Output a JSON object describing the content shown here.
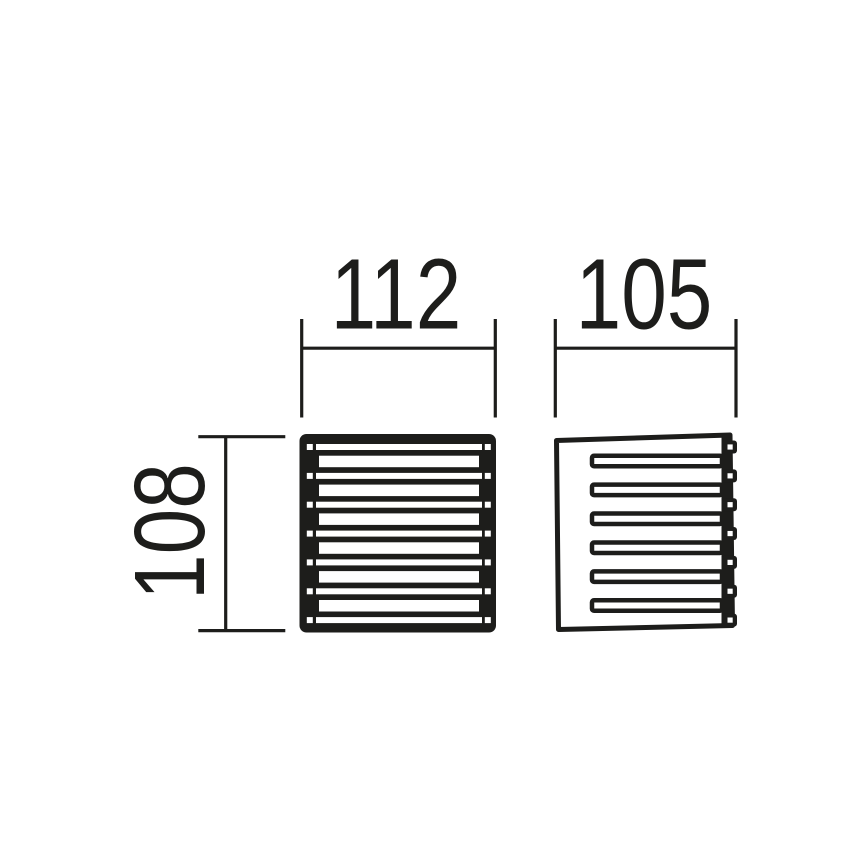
{
  "page": {
    "background_color": "#ffffff",
    "ink_color": "#1d1d1b"
  },
  "drawing": {
    "kind": "technical-dimension-drawing",
    "dimensions": {
      "front_width": {
        "value": "112"
      },
      "side_width": {
        "value": "105"
      },
      "height": {
        "value": "108"
      }
    },
    "front_view": {
      "description": "square louver grille, filled body with 7 thin slots (with corner screw holes) alternating with 6 wide slots",
      "thin_slot_count": 7,
      "wide_slot_count": 6,
      "hole_count": 14
    },
    "side_view": {
      "description": "outlined profile with 6 horizontal fins joined to a right-hand spine with 7 screw holes",
      "fin_count": 6,
      "hole_count": 7
    }
  }
}
